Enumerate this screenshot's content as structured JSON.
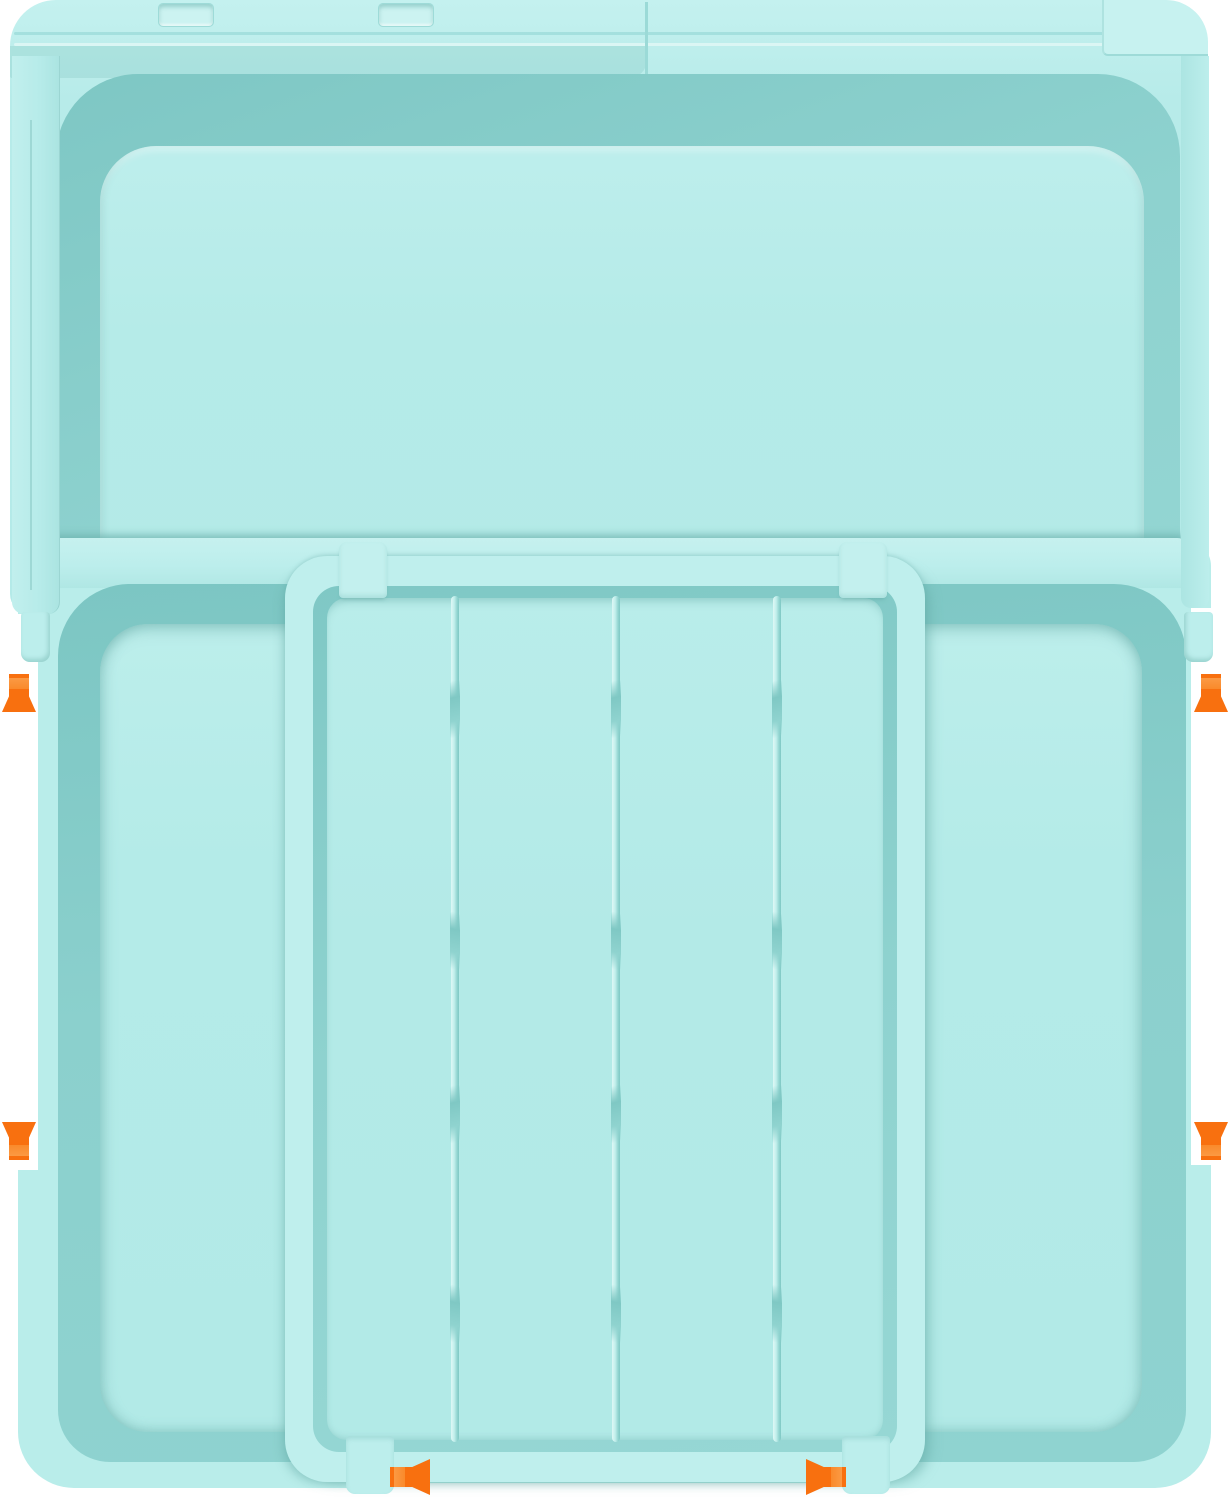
{
  "image": {
    "kind": "product illustration",
    "subject": "expandable drawer organizer tray, top view, with expansion direction arrows",
    "background_color": "#ffffff"
  },
  "palette": {
    "body_teal": "#b6ebe9",
    "body_teal_light": "#c6f2f0",
    "rim_teal": "#bfeeec",
    "wall_shadow_teal": "#8ad0cd",
    "wall_shadow_deep": "#7cc6c3",
    "seam_teal": "#9edbd8",
    "divider_highlight": "#dff8f6",
    "arrow_orange": "#f8700f",
    "arrow_orange_light": "#fa8a2b"
  },
  "structure": {
    "lid_latch_slots": 2,
    "lid_sliding_sections": 2,
    "side_compartments": 2,
    "tray_columns": 4,
    "tray_dividers": 3,
    "divider_joints_per_divider": 4,
    "slide_tabs": 4
  },
  "arrows": [
    {
      "id": "left-up",
      "direction": "up"
    },
    {
      "id": "left-down",
      "direction": "down"
    },
    {
      "id": "right-up",
      "direction": "up"
    },
    {
      "id": "right-down",
      "direction": "down"
    },
    {
      "id": "bottom-left",
      "direction": "left"
    },
    {
      "id": "bottom-right",
      "direction": "right"
    }
  ]
}
